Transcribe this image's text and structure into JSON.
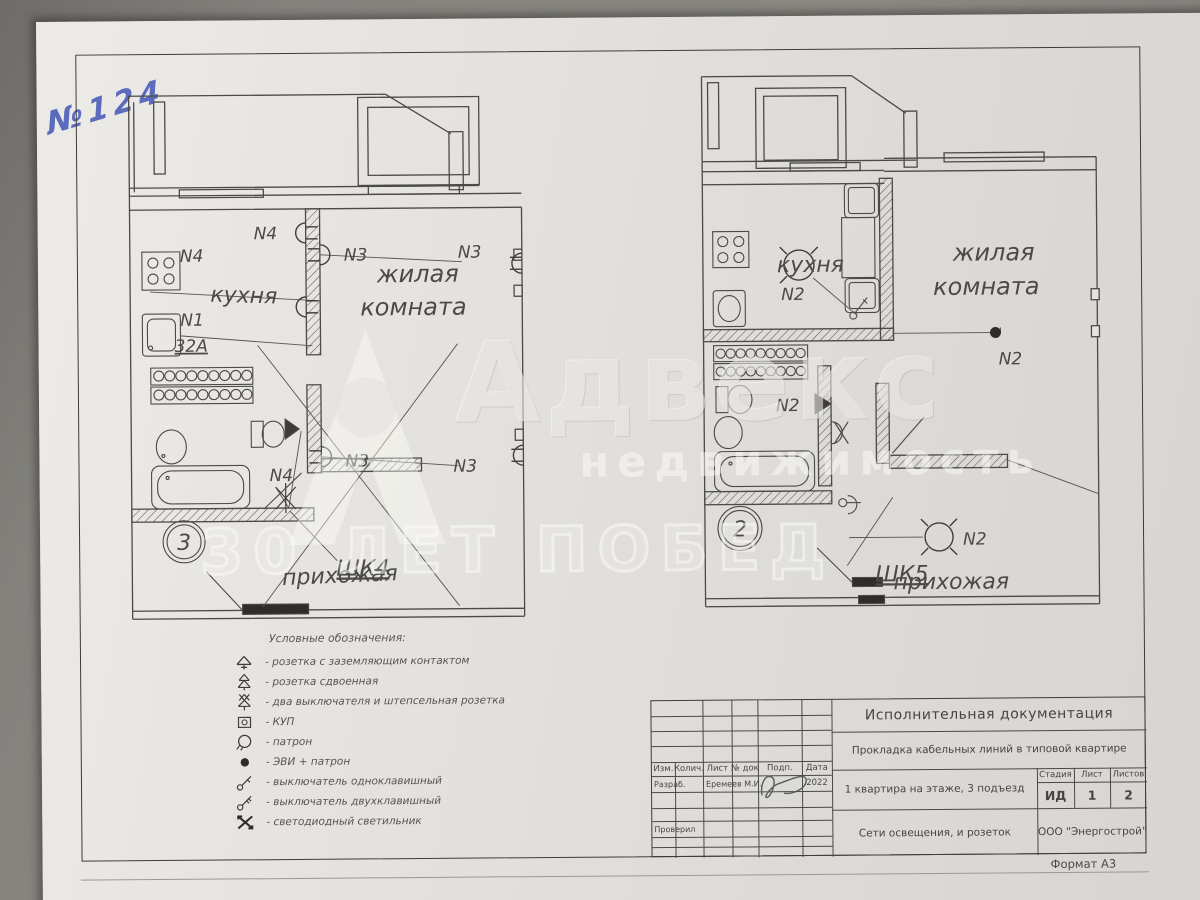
{
  "handnote": "№124",
  "watermark": {
    "brand": "Адвекс",
    "sub": "недвижимость",
    "slogan": "30 ЛЕТ ПОБЕД"
  },
  "plans": {
    "left": {
      "badge": "3",
      "kitchen": "кухня",
      "living_line1": "жилая",
      "living_line2": "комната",
      "hall": "прихожая",
      "cabinet": "ШК4",
      "n4_stove": "N4",
      "n1": "N1",
      "amp": "32A",
      "n4_wall": "N4",
      "n4_light": "N4",
      "n3_a": "N3",
      "n3_b": "N3",
      "n3_c": "N3",
      "n3_d": "N3"
    },
    "right": {
      "badge": "2",
      "kitchen": "кухня",
      "living_line1": "жилая",
      "living_line2": "комната",
      "hall": "прихожая",
      "cabinet": "ШК5",
      "n2_kitchen": "N2",
      "n2_living": "N2",
      "n2_bath": "N2",
      "n2_hall": "N2"
    }
  },
  "legend": {
    "title": "Условные обозначения:",
    "items": [
      {
        "icon": "socket-grounded-icon",
        "label": "- розетка с заземляющим контактом"
      },
      {
        "icon": "socket-double-icon",
        "label": "- розетка сдвоенная"
      },
      {
        "icon": "switches-socket-icon",
        "label": "- два выключателя и штепсельная розетка"
      },
      {
        "icon": "kup-icon",
        "label": "- КУП"
      },
      {
        "icon": "lamp-holder-icon",
        "label": "- патрон"
      },
      {
        "icon": "evi-lamp-icon",
        "label": "- ЭВИ + патрон"
      },
      {
        "icon": "switch-single-icon",
        "label": "- выключатель одноклавишный"
      },
      {
        "icon": "switch-double-icon",
        "label": "- выключатель двухклавишный"
      },
      {
        "icon": "led-light-icon",
        "label": "- светодиодный светильник"
      }
    ]
  },
  "titleblock": {
    "doc_type": "Исполнительная документация",
    "doc_title": "Прокладка кабельных линий в типовой квартире",
    "object": "1 квартира на этаже, 3 подъезд",
    "sheet_title": "Сети освещения, и розеток",
    "company": "ООО \"Энергострой\"",
    "col_izm": "Изм.",
    "col_kol": "Колич.",
    "col_list": "Лист",
    "col_ndoc": "№ док",
    "col_podp": "Подп.",
    "col_data": "Дата",
    "row_razrab": "Разраб.",
    "developer": "Еремеев М.И.",
    "year": "2022",
    "row_proveril": "Проверил",
    "stage_label": "Стадия",
    "sheet_label": "Лист",
    "sheets_label": "Листов",
    "stage": "ИД",
    "sheet": "1",
    "sheets": "2",
    "format": "Формат А3"
  }
}
